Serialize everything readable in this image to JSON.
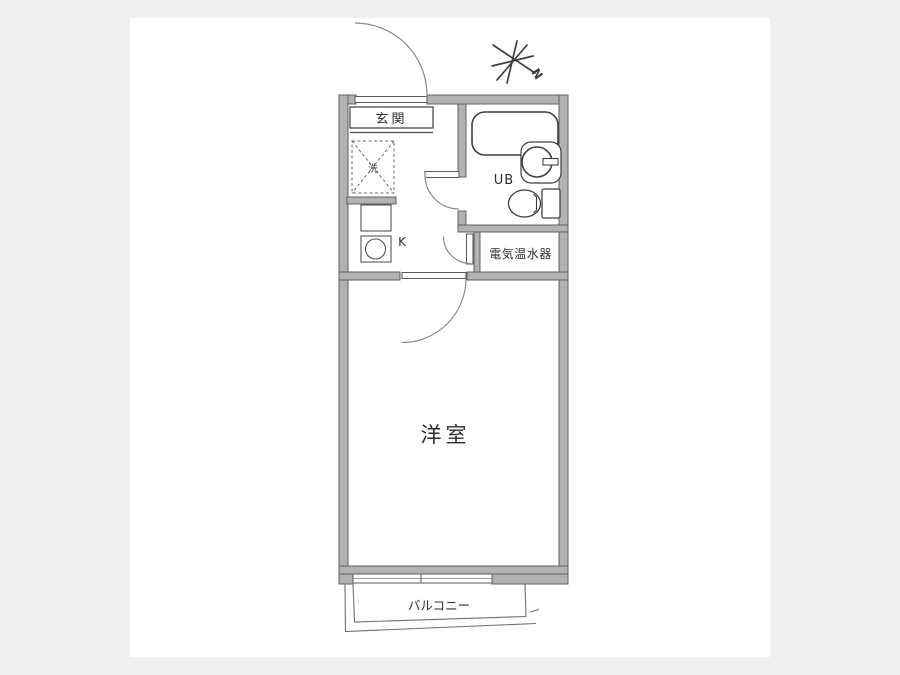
{
  "floor_plan": {
    "rooms": {
      "entrance": {
        "label": "玄関"
      },
      "washer_space": {
        "label": "洗"
      },
      "kitchen": {
        "label": "K"
      },
      "unit_bath": {
        "label": "UB"
      },
      "water_heater": {
        "label": "電気温水器"
      },
      "western_room": {
        "label": "洋室"
      },
      "balcony": {
        "label": "バルコニー"
      }
    },
    "north_indicator": {
      "letter": "N"
    },
    "icons": {
      "north_star": "eight-ray-hand-drawn-star",
      "bathtub": "rounded-rectangle",
      "washbasin": "circle-with-faucet-bar",
      "toilet": "oval-bowl-with-tank",
      "kitchen_sink": "square-with-circle",
      "kitchen_counter": "rectangle",
      "washer_space_symbol": "dashed-square-with-x",
      "door_swing": "quarter-circle-arc",
      "sliding_window": "double-line-band"
    },
    "colors": {
      "page_background": "#f0f0f0",
      "sheet_background": "#ffffff",
      "wall_fill": "#b2b2b2",
      "wall_outline": "#606060",
      "line": "#4a4a4a",
      "arc_line": "#8a8a8a"
    }
  }
}
